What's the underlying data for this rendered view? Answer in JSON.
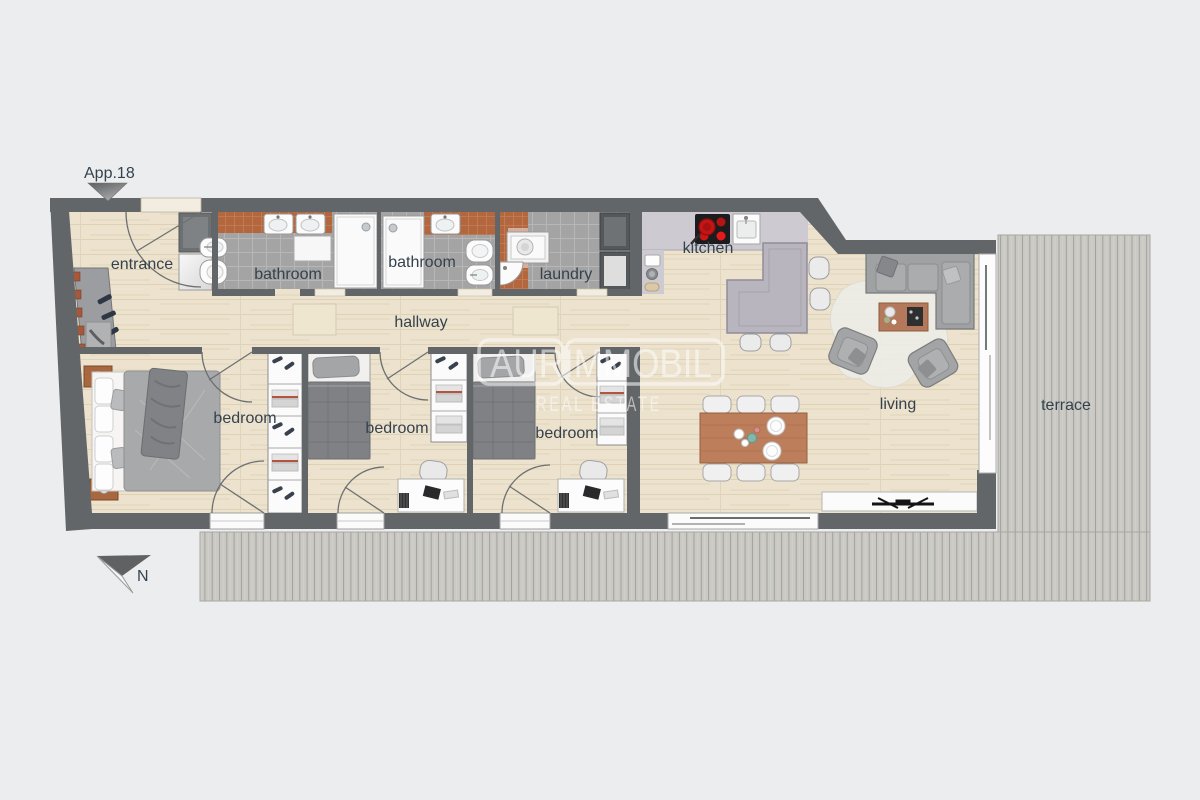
{
  "plan": {
    "app_label": "App.18",
    "compass_label": "N",
    "watermark": {
      "line1": "AURIMMOBIL",
      "line2": "REAL ESTATE"
    },
    "rooms": [
      {
        "id": "entrance",
        "label": "entrance"
      },
      {
        "id": "bathroom-1",
        "label": "bathroom"
      },
      {
        "id": "bathroom-2",
        "label": "bathroom"
      },
      {
        "id": "laundry",
        "label": "laundry"
      },
      {
        "id": "kitchen",
        "label": "kitchen"
      },
      {
        "id": "hallway",
        "label": "hallway"
      },
      {
        "id": "bedroom-master",
        "label": "bedroom"
      },
      {
        "id": "bedroom-2",
        "label": "bedroom"
      },
      {
        "id": "bedroom-3",
        "label": "bedroom"
      },
      {
        "id": "living",
        "label": "living"
      },
      {
        "id": "terrace",
        "label": "terrace"
      }
    ],
    "colors": {
      "background": "#ecedef",
      "wall": "#636669",
      "wood_floor": "#ece2cd",
      "tile_gray": "#a4a4a4",
      "tile_terracotta": "#b2673f",
      "deck": "#cac9c3",
      "counter": "#cdcbd1",
      "island": "#b9b5bf",
      "sofa": "#9fa1a3",
      "table_wood": "#bc7e5b",
      "stove_burner": "#d01818",
      "label_text": "#35424d",
      "watermark": "#ffffff"
    }
  }
}
